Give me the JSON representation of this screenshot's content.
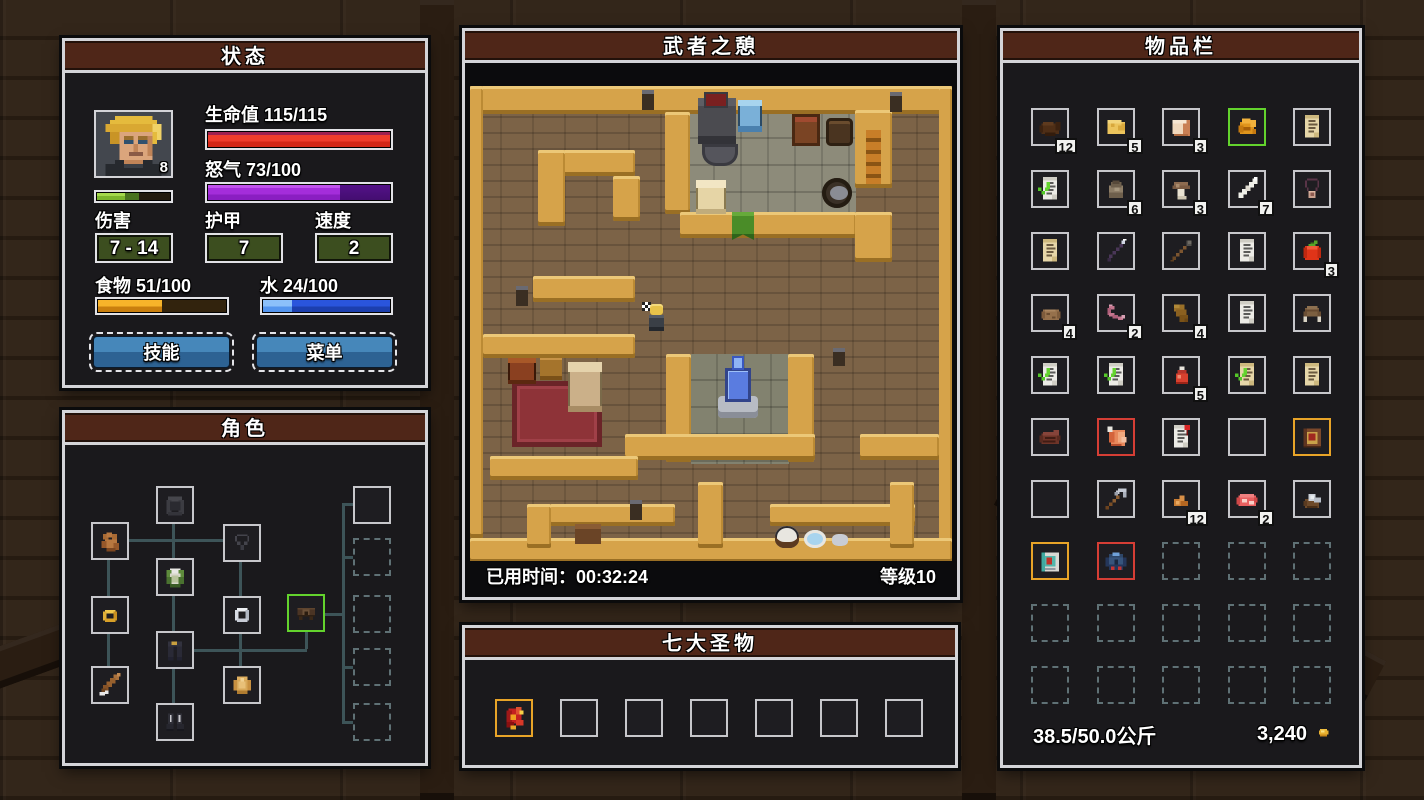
{
  "status": {
    "title": "状态",
    "portrait_level": "8",
    "hp_label": "生命值 115/115",
    "hp_pct": 100,
    "rage_label": "怒气 73/100",
    "rage_pct": 73,
    "xp": {
      "pct_bright": 40,
      "pct_total": 58
    },
    "damage_label": "伤害",
    "damage_value": "7 - 14",
    "armor_label": "护甲",
    "armor_value": "7",
    "speed_label": "速度",
    "speed_value": "2",
    "food_label": "食物 51/100",
    "food_pct": 51,
    "water_label": "水 24/100",
    "water_pct": 24,
    "skills_button": "技能",
    "menu_button": "菜单"
  },
  "character": {
    "title": "角色",
    "slots": [
      {
        "id": "head",
        "icon": "hood-icon"
      },
      {
        "id": "hands",
        "icon": "glove-icon"
      },
      {
        "id": "neck",
        "icon": "necklace-icon"
      },
      {
        "id": "chest",
        "icon": "tunic-icon"
      },
      {
        "id": "ring-left",
        "icon": "ring-gold-icon"
      },
      {
        "id": "ring-right",
        "icon": "ring-silver-icon"
      },
      {
        "id": "belt",
        "icon": "belt-icon",
        "border": "green"
      },
      {
        "id": "legs",
        "icon": "pants-icon"
      },
      {
        "id": "weapon",
        "icon": "sword-icon"
      },
      {
        "id": "offhand",
        "icon": "buckler-icon"
      },
      {
        "id": "feet",
        "icon": "boots-icon"
      },
      {
        "id": "extra"
      },
      {
        "id": "bag-1",
        "state": "dashed"
      },
      {
        "id": "bag-2",
        "state": "dashed"
      },
      {
        "id": "bag-3",
        "state": "dashed"
      },
      {
        "id": "bag-4",
        "state": "dashed"
      }
    ]
  },
  "map": {
    "title": "武者之憩",
    "elapsed_label": "已用时间：00:32:24",
    "level_label": "等级10"
  },
  "relics": {
    "title": "七大圣物",
    "slots": [
      {
        "icon": "relic-icon",
        "border": "gold"
      },
      {},
      {},
      {},
      {},
      {},
      {}
    ]
  },
  "inventory": {
    "title": "物品栏",
    "weight_label": "38.5/50.0公斤",
    "money": "3,240",
    "coin_icon": "coin-icon",
    "slots": [
      {
        "icon": "hide-icon",
        "count": 12
      },
      {
        "icon": "cheese-icon",
        "count": 5
      },
      {
        "icon": "bread-icon",
        "count": 3
      },
      {
        "icon": "roast-icon",
        "border": "green"
      },
      {
        "icon": "scroll-tan-icon"
      },
      {
        "icon": "scroll-check-icon"
      },
      {
        "icon": "pouch-icon",
        "count": 6
      },
      {
        "icon": "mushroom-icon",
        "count": 3
      },
      {
        "icon": "bone-icon",
        "count": 7
      },
      {
        "icon": "amulet-icon"
      },
      {
        "icon": "scroll-tan-icon"
      },
      {
        "icon": "wand-icon"
      },
      {
        "icon": "spear-icon"
      },
      {
        "icon": "scroll-white-icon"
      },
      {
        "icon": "tomato-icon",
        "count": 3
      },
      {
        "icon": "potato-icon",
        "count": 4
      },
      {
        "icon": "worm-icon",
        "count": 2
      },
      {
        "icon": "leather-icon",
        "count": 4
      },
      {
        "icon": "scroll-white-icon"
      },
      {
        "icon": "fur-hat-icon"
      },
      {
        "icon": "scroll-check-icon"
      },
      {
        "icon": "scroll-check-icon"
      },
      {
        "icon": "potion-icon",
        "count": 5
      },
      {
        "icon": "scroll-tan-check-icon"
      },
      {
        "icon": "scroll-tan-icon"
      },
      {
        "icon": "steak-cooked-icon"
      },
      {
        "icon": "ham-icon",
        "border": "red"
      },
      {
        "icon": "scroll-pin-icon"
      },
      {},
      {
        "icon": "book-brown-icon",
        "border": "gold"
      },
      {},
      {
        "icon": "pickaxe-icon"
      },
      {
        "icon": "nuggets-icon",
        "count": 12
      },
      {
        "icon": "steak-raw-icon",
        "count": 2
      },
      {
        "icon": "ore-icon"
      },
      {
        "icon": "book-teal-icon",
        "border": "gold"
      },
      {
        "icon": "armor-icon",
        "border": "red"
      },
      {
        "border": "dashed"
      },
      {
        "border": "dashed"
      },
      {
        "border": "dashed"
      },
      {
        "border": "dashed"
      },
      {
        "border": "dashed"
      },
      {
        "border": "dashed"
      },
      {
        "border": "dashed"
      },
      {
        "border": "dashed"
      },
      {
        "border": "dashed"
      },
      {
        "border": "dashed"
      },
      {
        "border": "dashed"
      },
      {
        "border": "dashed"
      },
      {
        "border": "dashed"
      }
    ]
  }
}
